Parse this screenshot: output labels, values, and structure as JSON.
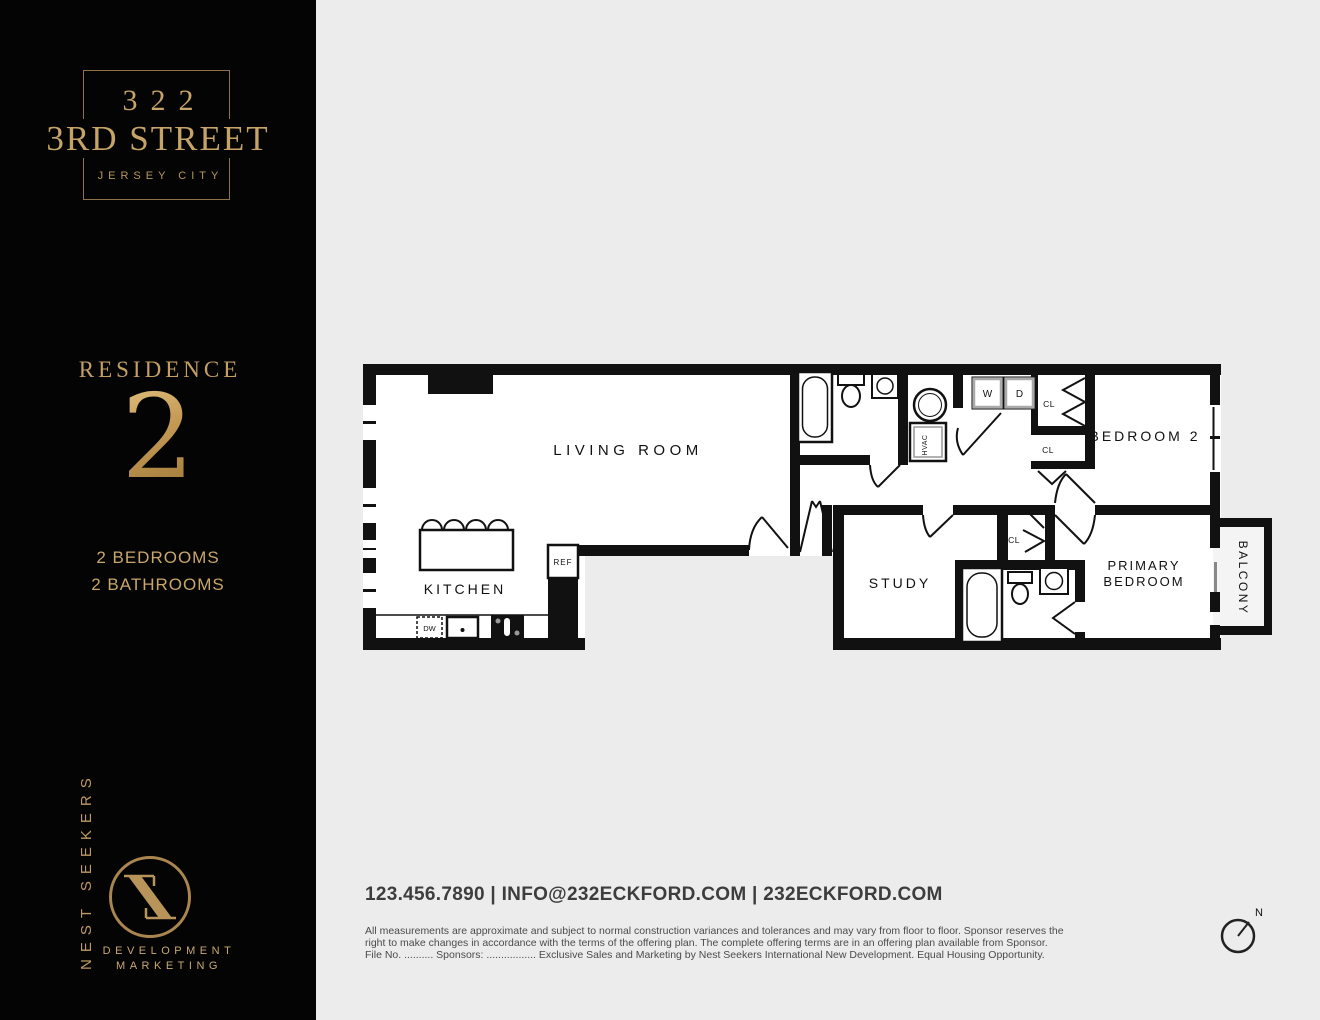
{
  "sidebar": {
    "building_number": "322",
    "building_street": "3RD STREET",
    "building_city": "JERSEY CITY",
    "residence_label": "RESIDENCE",
    "residence_number": "2",
    "bedrooms": "2 BEDROOMS",
    "bathrooms": "2 BATHROOMS",
    "brand_vertical": "NEST SEEKERS",
    "brand_line1": "DEVELOPMENT",
    "brand_line2": "MARKETING",
    "accent_gold": "#c6a366",
    "background": "#040404"
  },
  "floorplan": {
    "rooms": {
      "living": "LIVING ROOM",
      "kitchen": "KITCHEN",
      "study": "STUDY",
      "bedroom2": "BEDROOM 2",
      "primary_line1": "PRIMARY",
      "primary_line2": "BEDROOM",
      "balcony": "BALCONY"
    },
    "fixtures": {
      "ref": "REF",
      "dw": "DW",
      "washer": "W",
      "dryer": "D",
      "hvac": "HVAC",
      "cl": "CL"
    },
    "compass_n": "N",
    "wall_color": "#111111",
    "page_background": "#ececec"
  },
  "footer": {
    "contact": "123.456.7890 | INFO@232ECKFORD.COM | 232ECKFORD.COM",
    "disclaimer_line1": "All measurements are approximate and subject to normal construction variances and tolerances and may vary from floor to floor. Sponsor reserves the",
    "disclaimer_line2": "right to make changes in accordance with the terms of the offering plan. The complete offering terms are in an offering plan available from Sponsor.",
    "disclaimer_line3": "File No. .......... Sponsors: ................. Exclusive Sales and Marketing by Nest Seekers International New Development. Equal Housing Opportunity."
  }
}
